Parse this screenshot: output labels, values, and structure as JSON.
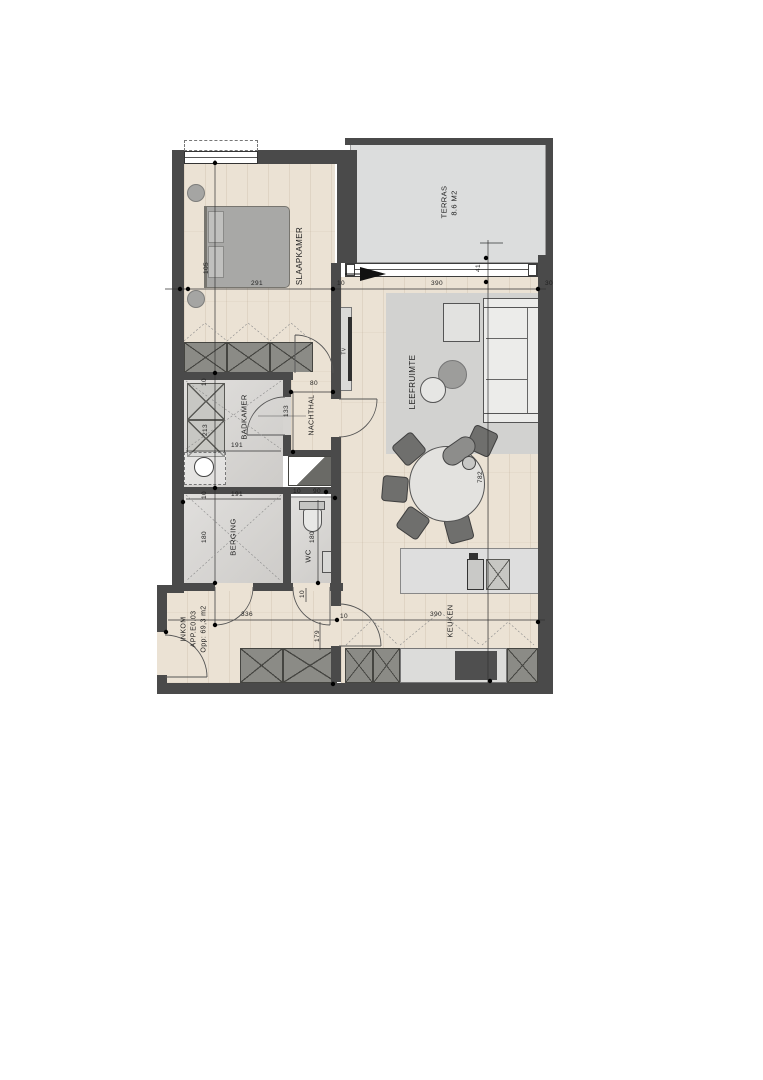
{
  "plan": {
    "rooms": [
      {
        "id": "slaapkamer",
        "label": "SLAAPKAMER"
      },
      {
        "id": "terras",
        "label": "TERRAS",
        "area": "8.6 M2"
      },
      {
        "id": "leefruimte",
        "label": "LEEFRUIMTE"
      },
      {
        "id": "badkamer",
        "label": "BADKAMER"
      },
      {
        "id": "nachthal",
        "label": "NACHTHAL"
      },
      {
        "id": "berging",
        "label": "BERGING"
      },
      {
        "id": "wc",
        "label": "WC"
      },
      {
        "id": "keuken",
        "label": "KEUKEN"
      },
      {
        "id": "inkom",
        "label": "INKOM",
        "unit": "APP.E0.03",
        "area": "Opp: 69,3 m2"
      }
    ],
    "furniture_labels": [
      {
        "id": "tv",
        "label": "TV"
      }
    ],
    "dimensions_cm": [
      105,
      291,
      10,
      390,
      30,
      41,
      782,
      10,
      213,
      191,
      10,
      191,
      180,
      80,
      133,
      10,
      90,
      180,
      10,
      336,
      10,
      179,
      390
    ],
    "colors": {
      "wall": "#4a4a4a",
      "wood_floor": "#ebe2d4",
      "tile_floor": "#d6d4d1",
      "terrace": "#dcdddd",
      "rug": "#d2d2d0",
      "cabinet": "#8b8b86",
      "furniture_gray": "#a8a8a6",
      "arrow": "#111111"
    }
  },
  "labels": [
    {
      "id": "slaapkamer",
      "text": "SLAAPKAMER",
      "x": 300,
      "y": 256,
      "r": -90,
      "s": 8
    },
    {
      "id": "terras",
      "text": "TERRAS",
      "x": 444,
      "y": 202,
      "r": -90,
      "s": 7.5
    },
    {
      "id": "terras-area",
      "text": "8.6 M2",
      "x": 454,
      "y": 203,
      "r": -90,
      "s": 7.5
    },
    {
      "id": "leefruimte",
      "text": "LEEFRUIMTE",
      "x": 413,
      "y": 382,
      "r": -90,
      "s": 8
    },
    {
      "id": "badkamer",
      "text": "BADKAMER",
      "x": 244,
      "y": 417,
      "r": -90,
      "s": 7.5
    },
    {
      "id": "nachthal",
      "text": "NACHTHAL",
      "x": 312,
      "y": 415,
      "r": -90,
      "s": 7
    },
    {
      "id": "berging",
      "text": "BERGING",
      "x": 233,
      "y": 537,
      "r": -90,
      "s": 7.5
    },
    {
      "id": "wc",
      "text": "WC",
      "x": 308,
      "y": 556,
      "r": -90,
      "s": 7.5
    },
    {
      "id": "keuken",
      "text": "KEUKEN",
      "x": 450,
      "y": 621,
      "r": -90,
      "s": 7.5
    },
    {
      "id": "inkom",
      "text": "INKOM",
      "x": 184,
      "y": 629,
      "r": -90,
      "s": 7
    },
    {
      "id": "inkom-unit",
      "text": "APP.E0.03",
      "x": 194,
      "y": 629,
      "r": -90,
      "s": 7
    },
    {
      "id": "inkom-area",
      "text": "Opp: 69,3 m2",
      "x": 204,
      "y": 629,
      "r": -90,
      "s": 7
    },
    {
      "id": "tv",
      "text": "TV",
      "x": 345,
      "y": 351,
      "r": -90,
      "s": 5
    },
    {
      "id": "d105",
      "text": "105",
      "x": 207,
      "y": 268,
      "r": -90,
      "s": 6.5
    },
    {
      "id": "d291",
      "text": "291",
      "x": 257,
      "y": 284,
      "r": 0,
      "s": 6.5
    },
    {
      "id": "d10a",
      "text": "10",
      "x": 341,
      "y": 284,
      "r": 0,
      "s": 6.5
    },
    {
      "id": "d390a",
      "text": "390",
      "x": 437,
      "y": 284,
      "r": 0,
      "s": 6.5
    },
    {
      "id": "d30",
      "text": "30",
      "x": 549,
      "y": 284,
      "r": 0,
      "s": 6.5
    },
    {
      "id": "d41",
      "text": "41",
      "x": 479,
      "y": 268,
      "r": -90,
      "s": 6.5
    },
    {
      "id": "d782",
      "text": "782",
      "x": 481,
      "y": 477,
      "r": -90,
      "s": 6.5
    },
    {
      "id": "d10b",
      "text": "10",
      "x": 205,
      "y": 382,
      "r": -90,
      "s": 6.5
    },
    {
      "id": "d213",
      "text": "213",
      "x": 206,
      "y": 430,
      "r": -90,
      "s": 6.5
    },
    {
      "id": "d191a",
      "text": "191",
      "x": 237,
      "y": 446,
      "r": 0,
      "s": 6.5
    },
    {
      "id": "d10c",
      "text": "10",
      "x": 205,
      "y": 495,
      "r": -90,
      "s": 6.5
    },
    {
      "id": "d191b",
      "text": "191",
      "x": 237,
      "y": 495,
      "r": 0,
      "s": 6.5
    },
    {
      "id": "d180a",
      "text": "180",
      "x": 205,
      "y": 537,
      "r": -90,
      "s": 6.5
    },
    {
      "id": "d80",
      "text": "80",
      "x": 314,
      "y": 384,
      "r": 0,
      "s": 6.5
    },
    {
      "id": "d133",
      "text": "133",
      "x": 287,
      "y": 411,
      "r": -90,
      "s": 6.5
    },
    {
      "id": "d10d",
      "text": "10",
      "x": 297,
      "y": 492,
      "r": 0,
      "s": 6.5
    },
    {
      "id": "d90",
      "text": "90",
      "x": 317,
      "y": 492,
      "r": 0,
      "s": 6.5
    },
    {
      "id": "d180b",
      "text": "180",
      "x": 313,
      "y": 537,
      "r": -90,
      "s": 6.5
    },
    {
      "id": "d10e",
      "text": "10",
      "x": 303,
      "y": 594,
      "r": -90,
      "s": 6.5
    },
    {
      "id": "d336",
      "text": "336",
      "x": 247,
      "y": 615,
      "r": 0,
      "s": 6.5
    },
    {
      "id": "d10f",
      "text": "10",
      "x": 344,
      "y": 617,
      "r": 0,
      "s": 6.5
    },
    {
      "id": "d179",
      "text": "179",
      "x": 318,
      "y": 636,
      "r": -90,
      "s": 6.5
    },
    {
      "id": "d390b",
      "text": "390",
      "x": 436,
      "y": 615,
      "r": 0,
      "s": 6.5
    }
  ]
}
